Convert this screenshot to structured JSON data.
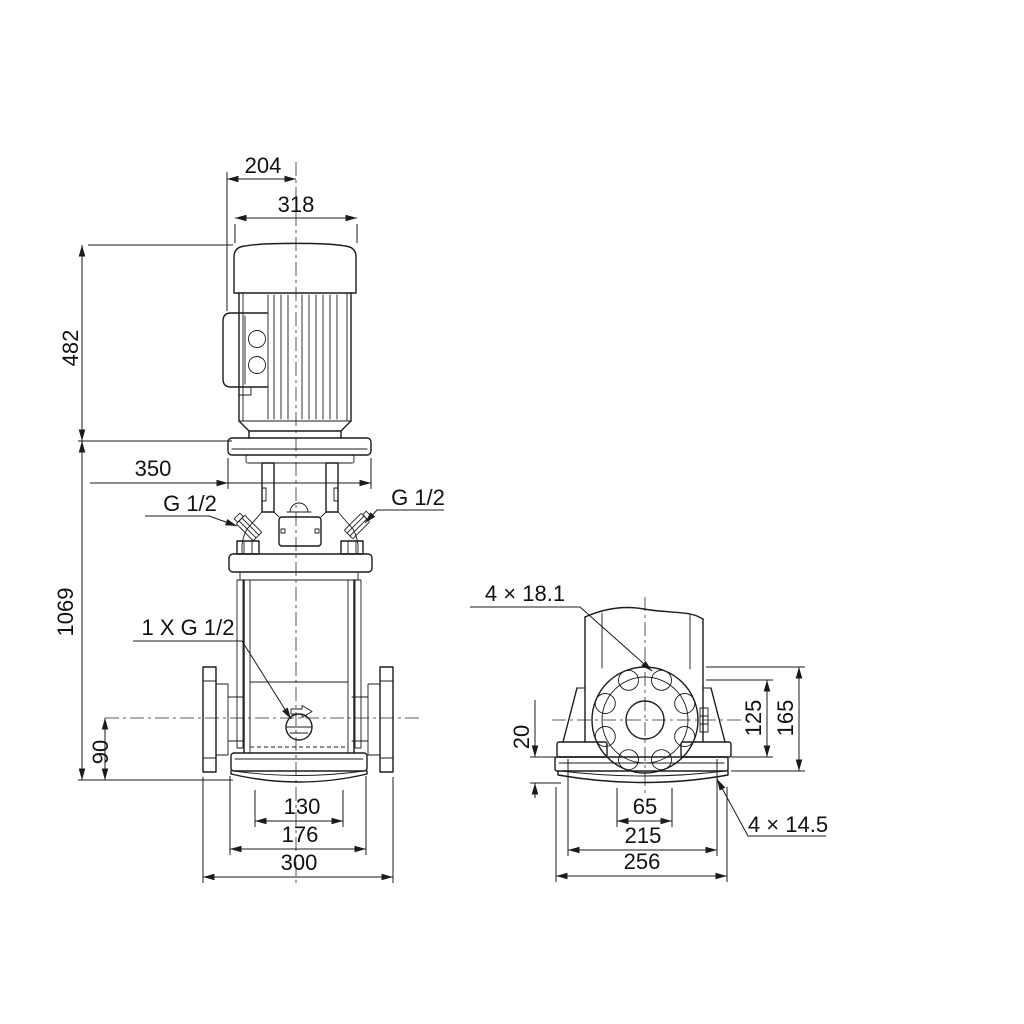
{
  "drawing": {
    "front_view": {
      "dim_204": "204",
      "dim_318": "318",
      "dim_482": "482",
      "dim_1069": "1069",
      "dim_350": "350",
      "dim_90": "90",
      "dim_130": "130",
      "dim_176": "176",
      "dim_300": "300",
      "plug_left": "G 1/2",
      "plug_right": "G 1/2",
      "drain_label": "1 X G 1/2"
    },
    "side_view": {
      "flange_holes_label": "4 × 18.1",
      "dim_125": "125",
      "dim_165": "165",
      "dim_20": "20",
      "dim_65": "65",
      "dim_215": "215",
      "dim_256": "256",
      "base_holes_label": "4 × 14.5"
    }
  }
}
